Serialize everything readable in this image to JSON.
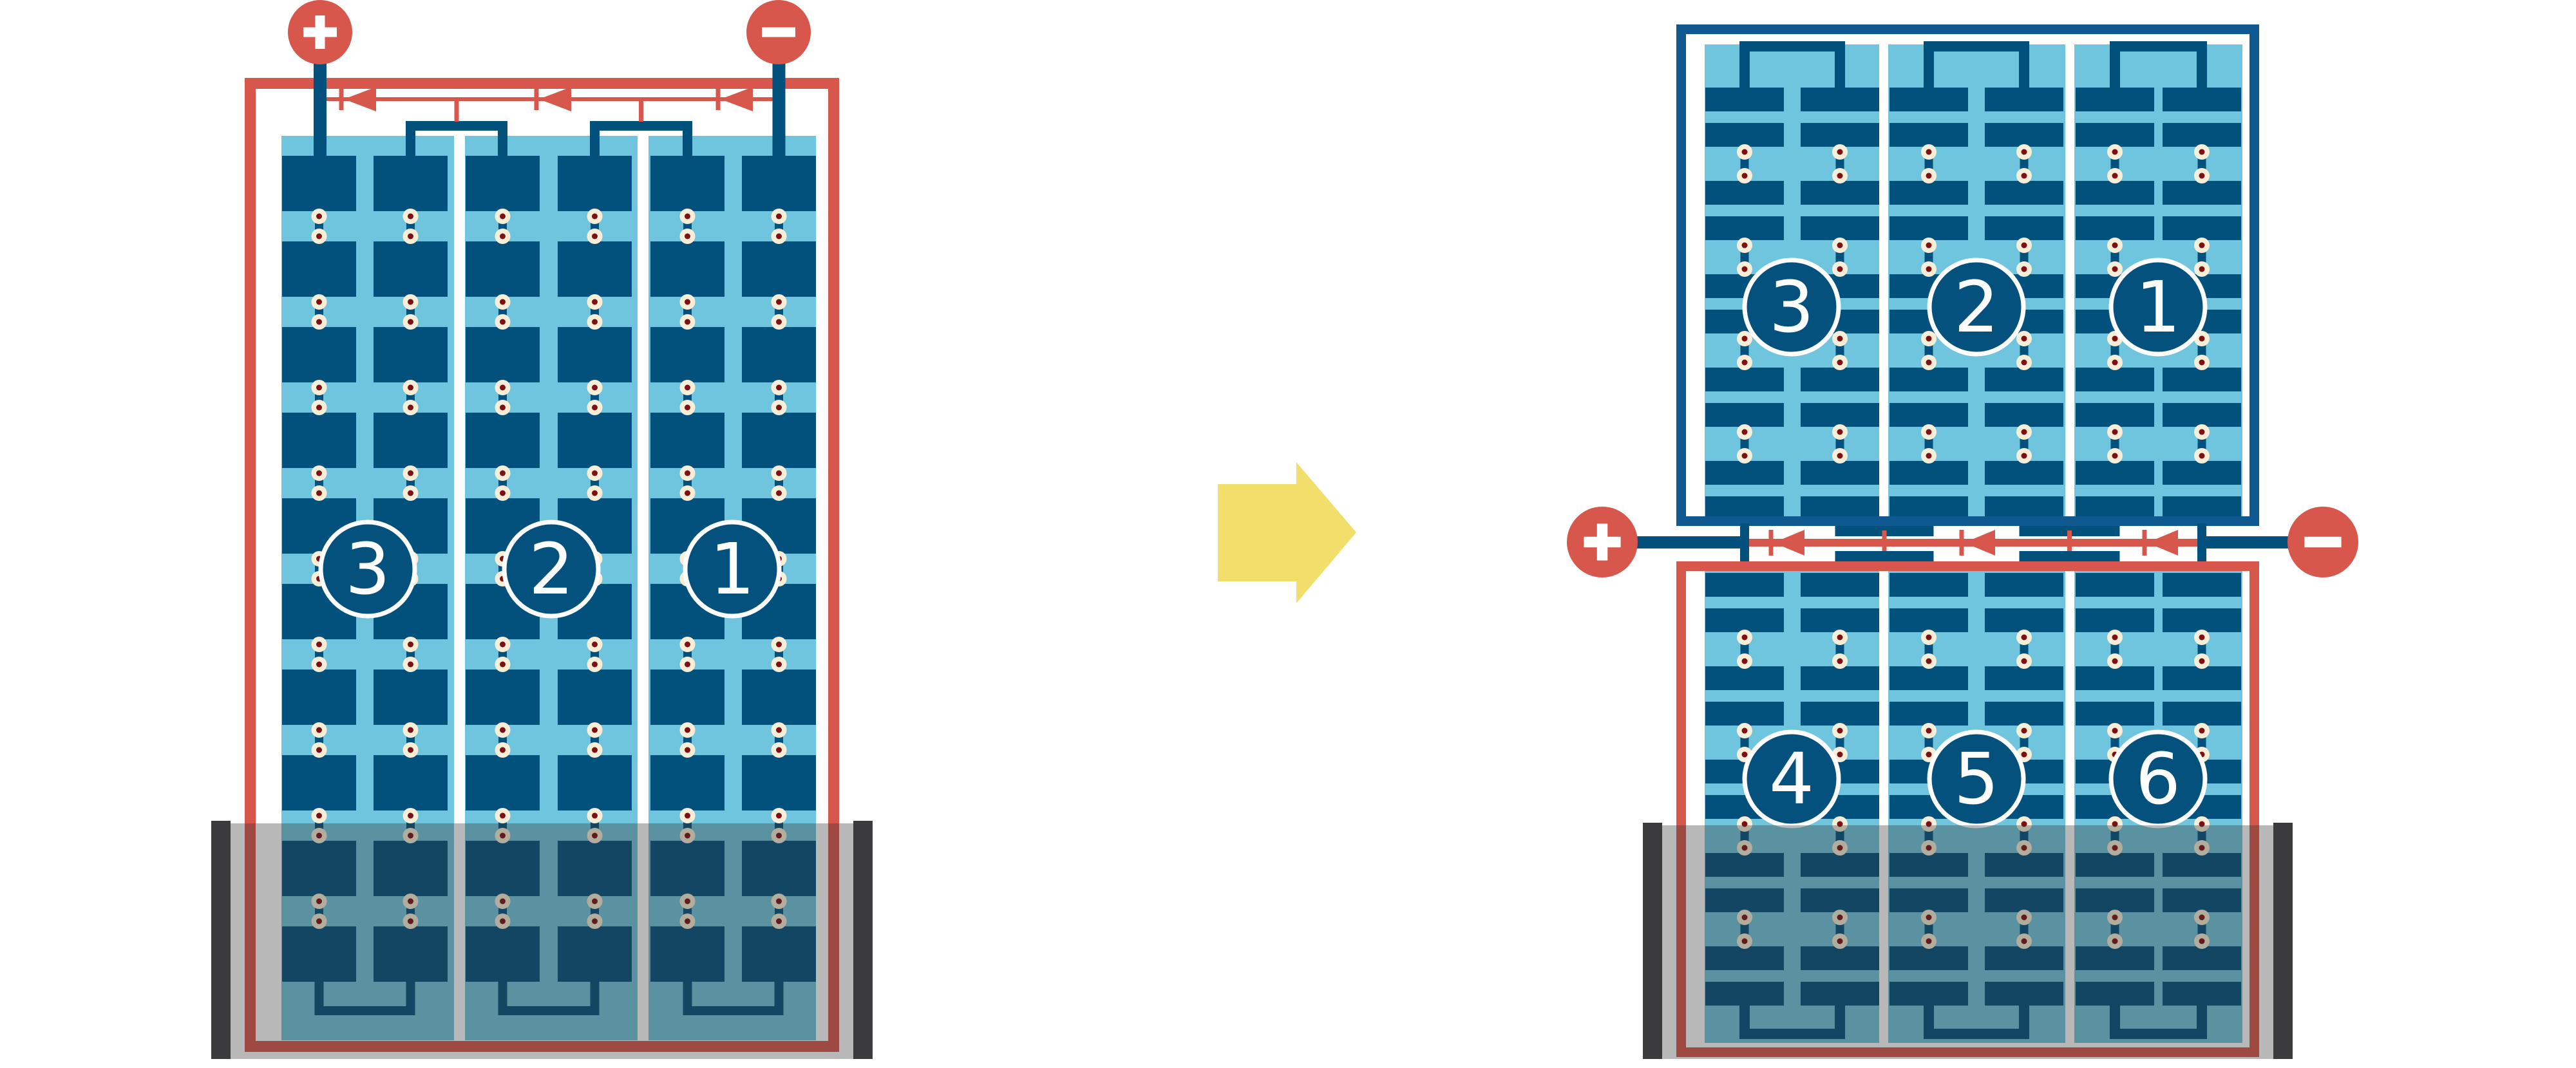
{
  "diagram": {
    "description": "solar-module-bypass-diode-comparison",
    "colors": {
      "red": "#D8574C",
      "dark_blue": "#02517D",
      "frame_blue": "#0F5990",
      "light_blue": "#6FC5DD",
      "pad_cream": "#F8EED8",
      "pad_maroon": "#7D1013",
      "shade_bar": "#3B3B3D",
      "shade_overlay": "rgba(52,52,52,0.35)",
      "arrow_yellow": "#F2DE6A",
      "white": "#FFFFFF",
      "circle_fill": "#05517E"
    },
    "arrow": {
      "direction": "right"
    },
    "left_module": {
      "type": "full-cell-module",
      "terminals": [
        {
          "symbol": "+"
        },
        {
          "symbol": "-"
        }
      ],
      "bypass_diode_count": 3,
      "strings": [
        {
          "label": "3"
        },
        {
          "label": "2"
        },
        {
          "label": "1"
        }
      ],
      "cells_per_substring": 10,
      "shaded_bottom": true
    },
    "right_top_module": {
      "type": "half-cell-module-upper-half",
      "strings": [
        {
          "label": "3"
        },
        {
          "label": "2"
        },
        {
          "label": "1"
        }
      ],
      "cell_pairs_per_substring": 5,
      "shaded_bottom": false
    },
    "right_bottom_module": {
      "type": "half-cell-module-lower-half",
      "strings": [
        {
          "label": "4"
        },
        {
          "label": "5"
        },
        {
          "label": "6"
        }
      ],
      "cell_pairs_per_substring": 5,
      "shaded_bottom": true
    },
    "right_terminals": [
      {
        "symbol": "+"
      },
      {
        "symbol": "-"
      }
    ],
    "right_bypass_diode_count": 3
  }
}
